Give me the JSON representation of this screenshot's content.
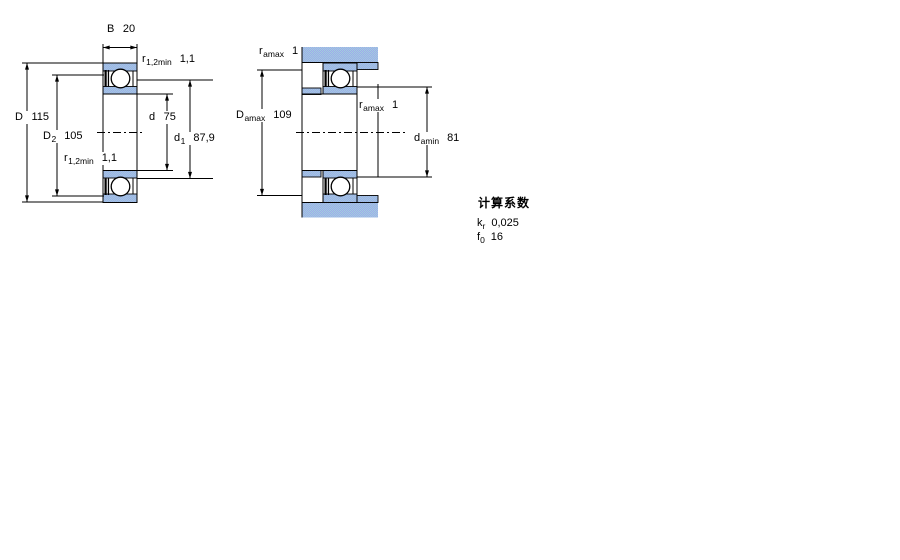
{
  "labels": {
    "b": {
      "sym": "B",
      "sub": "",
      "val": "20"
    },
    "r12_top": {
      "sym": "r",
      "sub": "1,2min",
      "val": "1,1"
    },
    "big_d": {
      "sym": "D",
      "sub": "",
      "val": "115"
    },
    "d2": {
      "sym": "D",
      "sub": "2",
      "val": "105"
    },
    "r12_bot": {
      "sym": "r",
      "sub": "1,2min",
      "val": "1,1"
    },
    "d": {
      "sym": "d",
      "sub": "",
      "val": "75"
    },
    "d1": {
      "sym": "d",
      "sub": "1",
      "val": "87,9"
    },
    "ramax_top": {
      "sym": "r",
      "sub": "amax",
      "val": "1"
    },
    "damax": {
      "sym": "D",
      "sub": "amax",
      "val": "109"
    },
    "ramax_mid": {
      "sym": "r",
      "sub": "amax",
      "val": "1"
    },
    "damin": {
      "sym": "d",
      "sub": "amin",
      "val": "81"
    }
  },
  "factors": {
    "title": "计算系数",
    "rows": [
      {
        "sym": "k",
        "sub": "r",
        "val": "0,025"
      },
      {
        "sym": "f",
        "sub": "0",
        "val": "16"
      }
    ]
  },
  "colors": {
    "line": "#000000",
    "section_fill_a": "#9fd0dc",
    "section_fill_b": "#a0a8ec",
    "background": "#ffffff"
  }
}
